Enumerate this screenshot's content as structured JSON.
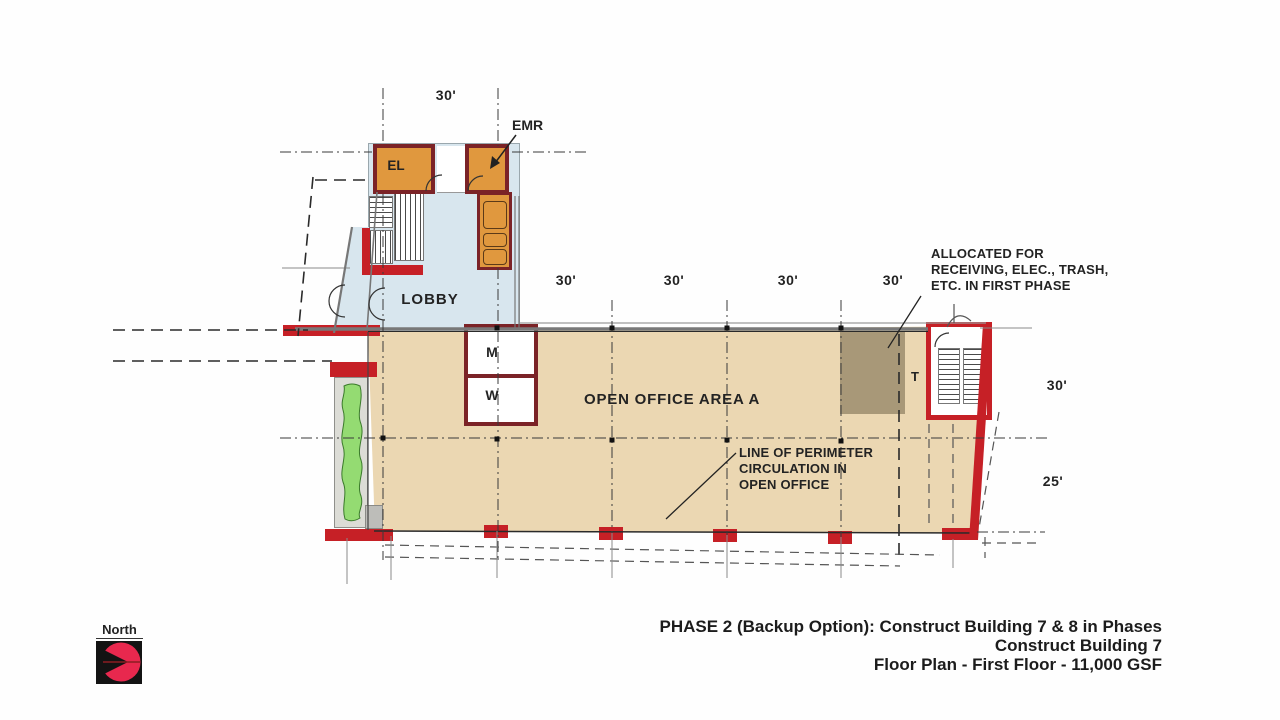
{
  "labels": {
    "el": "EL",
    "emr": "EMR",
    "lobby": "LOBBY",
    "mens": "M",
    "womens": "W",
    "toilet": "T",
    "open_office": "OPEN OFFICE AREA A",
    "north": "North"
  },
  "dimensions": {
    "top": "30'",
    "bays": [
      "30'",
      "30'",
      "30'",
      "30'"
    ],
    "right_upper": "30'",
    "right_lower": "25'"
  },
  "annotations": {
    "receiving_line1": "ALLOCATED FOR",
    "receiving_line2": "RECEIVING, ELEC., TRASH,",
    "receiving_line3": "ETC. IN FIRST PHASE",
    "perimeter_line1": "LINE OF PERIMETER",
    "perimeter_line2": "CIRCULATION IN",
    "perimeter_line3": "OPEN OFFICE"
  },
  "title_block": {
    "line1": "PHASE 2 (Backup Option): Construct Building 7 & 8 in Phases",
    "line2": "Construct Building 7",
    "line3": "Floor Plan - First Floor - 11,000 GSF"
  },
  "colors": {
    "wall_red": "#C62026",
    "wall_maroon": "#7B2327",
    "room_orange": "#E0983E",
    "lobby_blue": "#D8E6EE",
    "office_tan": "#EBD7B2",
    "receiving_brown": "#A89878",
    "landscape_green": "#94DB72",
    "logo_red": "#E8284E"
  }
}
